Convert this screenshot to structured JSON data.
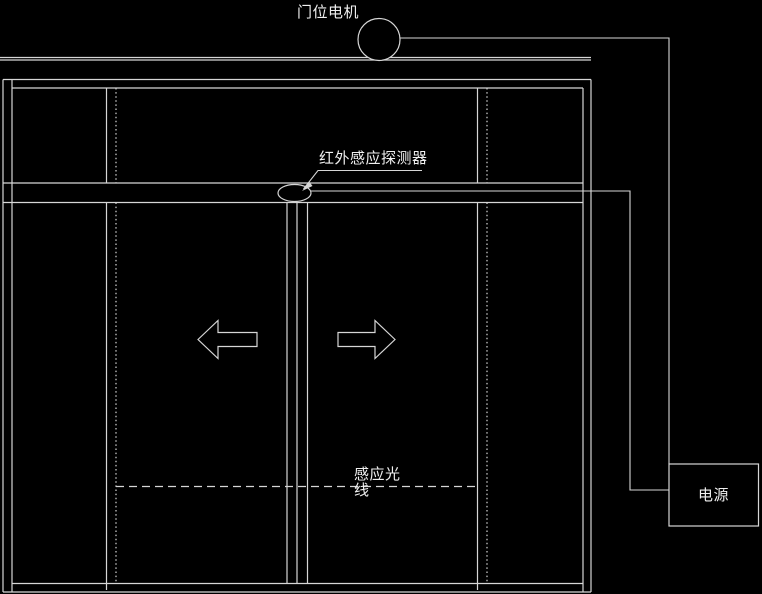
{
  "diagram": {
    "type": "cad-schematic",
    "subject": "automatic sliding door with infrared sensor",
    "colors": {
      "background": "#000000",
      "line": "#d6d6d6",
      "text": "#f0f0f0"
    },
    "labels": {
      "motor": "门位电机",
      "sensor": "红外感应探测器",
      "beam_line1": "感应光",
      "beam_line2": "线",
      "power": "电源"
    },
    "components": [
      {
        "name": "door-motor-circle-icon",
        "shape": "circle"
      },
      {
        "name": "infrared-sensor-ellipse-icon",
        "shape": "ellipse"
      },
      {
        "name": "power-supply-box",
        "shape": "rectangle"
      },
      {
        "name": "door-open-left-arrow-icon",
        "shape": "arrow-left"
      },
      {
        "name": "door-open-right-arrow-icon",
        "shape": "arrow-right"
      },
      {
        "name": "sensing-beam-dashed-line",
        "shape": "dashed-line"
      }
    ]
  }
}
